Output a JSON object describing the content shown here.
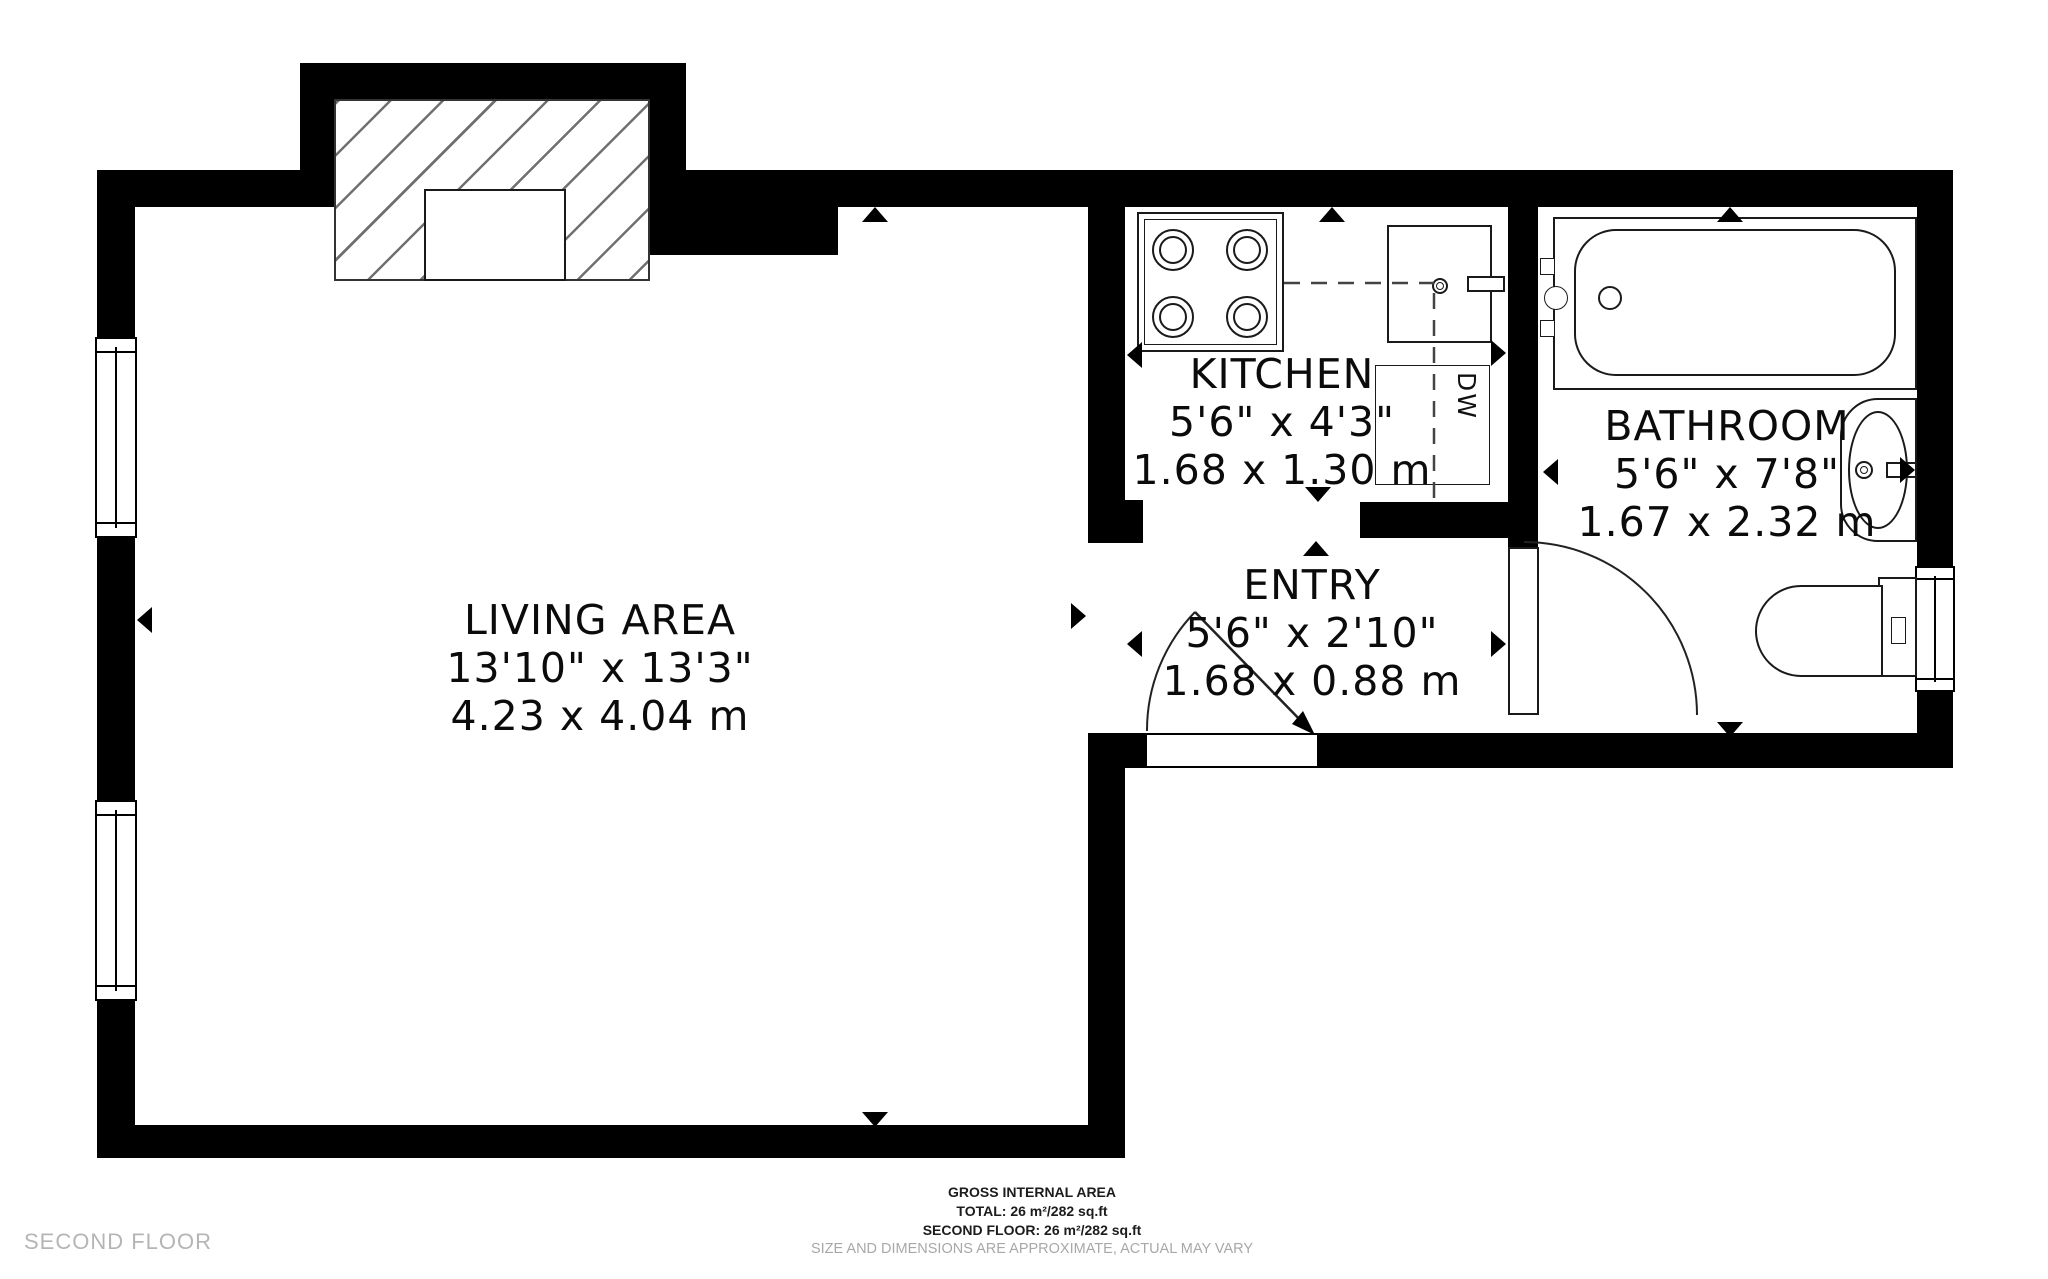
{
  "plan_type": "floor-plan",
  "rooms": [
    {
      "id": "living",
      "name": "LIVING AREA",
      "imperial": "13'10\" x 13'3\"",
      "metric": "4.23 x 4.04 m"
    },
    {
      "id": "kitchen",
      "name": "KITCHEN",
      "imperial": "5'6\" x 4'3\"",
      "metric": "1.68 x 1.30 m"
    },
    {
      "id": "entry",
      "name": "ENTRY",
      "imperial": "5'6\" x 2'10\"",
      "metric": "1.68 x 0.88 m"
    },
    {
      "id": "bathroom",
      "name": "BATHROOM",
      "imperial": "5'6\" x 7'8\"",
      "metric": "1.67 x 2.32 m"
    }
  ],
  "fixtures": {
    "dishwasher_label": "DW"
  },
  "footer": {
    "floor_label": "SECOND FLOOR",
    "area_title": "GROSS INTERNAL AREA",
    "total_line": "TOTAL: 26 m²/282 sq.ft",
    "floor_line": "SECOND FLOOR: 26 m²/282 sq.ft",
    "disclaimer": "SIZE AND DIMENSIONS ARE APPROXIMATE, ACTUAL MAY VARY"
  },
  "colors": {
    "wall": "#000000",
    "line": "#1a1a1a",
    "text": "#0b0b0b",
    "muted_text": "#a8a8a8",
    "floor_label_text": "#b5b5b5",
    "background": "#ffffff"
  }
}
